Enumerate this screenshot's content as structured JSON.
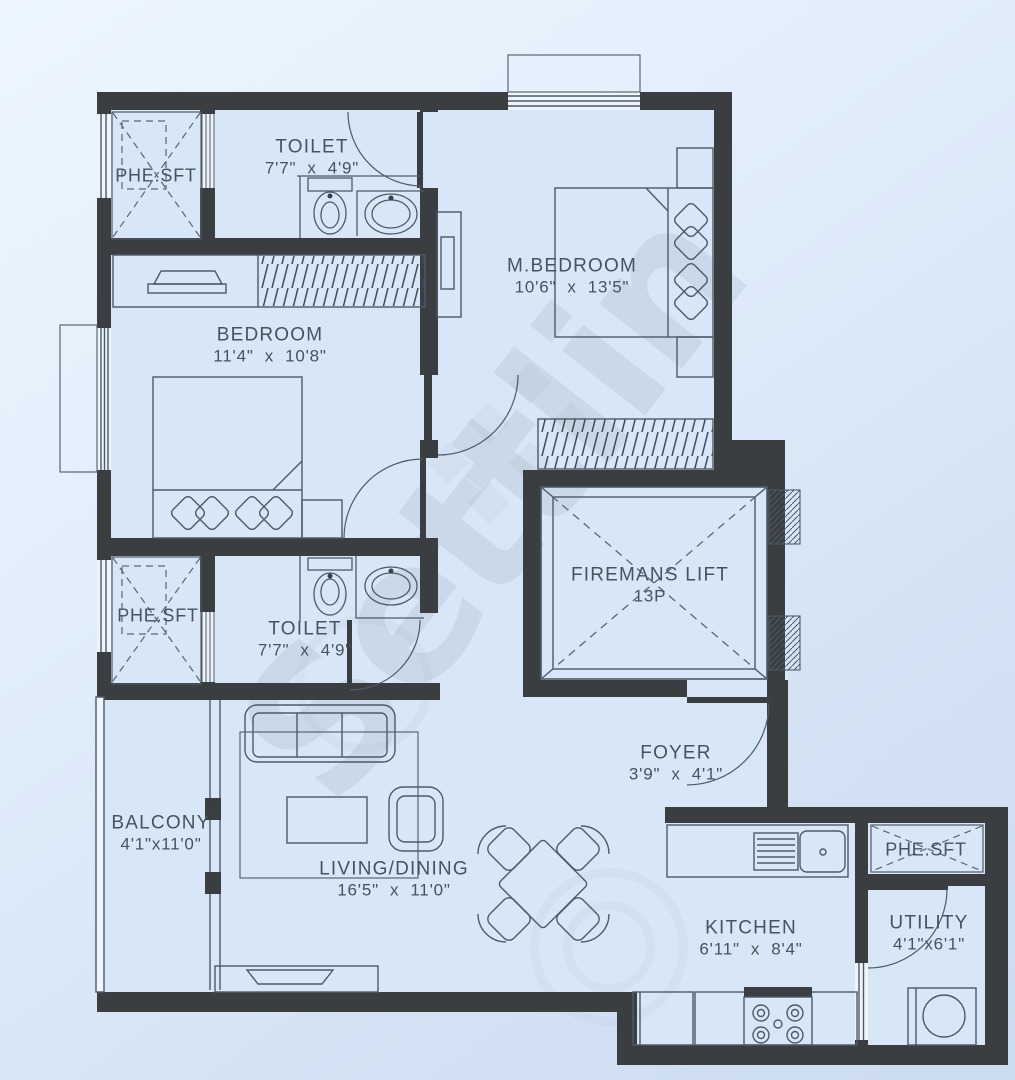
{
  "watermark": {
    "text": "Settlin"
  },
  "rooms": [
    {
      "id": "toilet-1",
      "name": "TOILET",
      "dims": "7'7\"  x  4'9\""
    },
    {
      "id": "m-bedroom",
      "name": "M.BEDROOM",
      "dims": "10'6\"  x  13'5\""
    },
    {
      "id": "bedroom",
      "name": "BEDROOM",
      "dims": "11'4\"  x  10'8\""
    },
    {
      "id": "phe-sft-1",
      "name": "PHE.SFT",
      "dims": ""
    },
    {
      "id": "phe-sft-2",
      "name": "PHE.SFT",
      "dims": ""
    },
    {
      "id": "toilet-2",
      "name": "TOILET",
      "dims": "7'7\"  x  4'9\""
    },
    {
      "id": "firemans-lift",
      "name": "FIREMANS  LIFT",
      "dims": "13P"
    },
    {
      "id": "balcony",
      "name": "BALCONY",
      "dims": "4'1\"x11'0\""
    },
    {
      "id": "living-dining",
      "name": "LIVING/DINING",
      "dims": "16'5\"  x  11'0\""
    },
    {
      "id": "foyer",
      "name": "FOYER",
      "dims": "3'9\"  x  4'1\""
    },
    {
      "id": "kitchen",
      "name": "KITCHEN",
      "dims": "6'11\"  x  8'4\""
    },
    {
      "id": "utility",
      "name": "UTILITY",
      "dims": "4'1\"x6'1\""
    },
    {
      "id": "phe-sft-3",
      "name": "PHE.SFT",
      "dims": ""
    }
  ],
  "colors": {
    "wall": "#3a3e41",
    "floor": "#d8e7f7",
    "line": "#4d5a68",
    "label": "#48525e",
    "watermark": "#8795a5",
    "background_top": "#edf6fe",
    "background_bottom": "#ccdcf0"
  }
}
